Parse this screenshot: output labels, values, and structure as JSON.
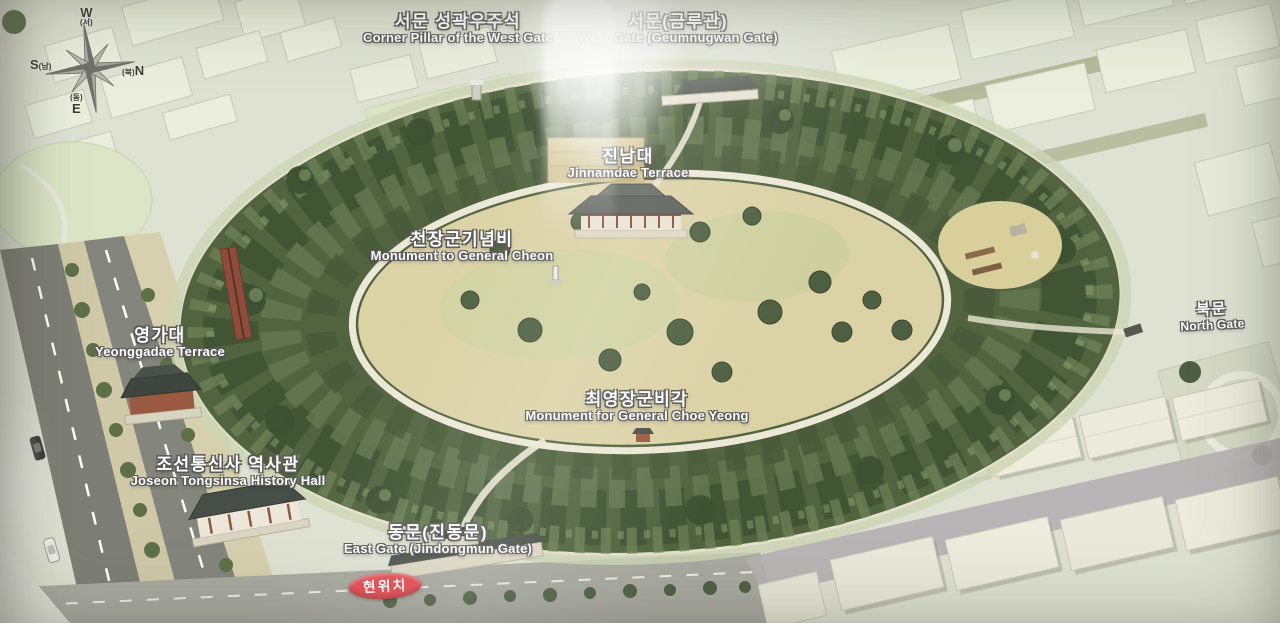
{
  "photo": {
    "alt": "Bird's-eye illustrated guide map of Jaseongdae fortress park"
  },
  "compass": {
    "west": {
      "letter": "W",
      "hangul": "(서)"
    },
    "south": {
      "letter": "S",
      "hangul": "(남)"
    },
    "north": {
      "letter": "N",
      "hangul": "(북)"
    },
    "east": {
      "letter": "E",
      "hangul": "(동)"
    }
  },
  "labels": [
    {
      "id": "corner-pillar-west-gate",
      "ko": "서문 성곽우주석",
      "en": "Corner Pillar of the West Gate"
    },
    {
      "id": "west-gate",
      "ko": "서문(금루관)",
      "en": "West Gate (Geumnugwan Gate)"
    },
    {
      "id": "jinnamdae-terrace",
      "ko": "진남대",
      "en": "Jinnamdae Terrace"
    },
    {
      "id": "monument-general-cheon",
      "ko": "천장군기념비",
      "en": "Monument to General Cheon"
    },
    {
      "id": "yeonggadae-terrace",
      "ko": "영가대",
      "en": "Yeonggadae Terrace"
    },
    {
      "id": "north-gate",
      "ko": "북문",
      "en": "North Gate"
    },
    {
      "id": "monument-general-choe",
      "ko": "최영장군비각",
      "en": "Monument for General Choe Yeong"
    },
    {
      "id": "joseon-tongsinsa-hall",
      "ko": "조선통신사 역사관",
      "en": "Joseon Tongsinsa History Hall"
    },
    {
      "id": "east-gate",
      "ko": "동문(진동문)",
      "en": "East Gate (Jindongmun Gate)"
    }
  ],
  "current_location_badge": {
    "text": "현위치",
    "bg_color": "#e8464d",
    "text_color": "#ffffff"
  },
  "colors": {
    "background": "#dfe2d3",
    "city_block": "#ebeedd",
    "block_shadow": "#99a077",
    "tree_ring": "#51643f",
    "tree_dark": "#3f5233",
    "tree_light": "#70835a",
    "clearing": "#dbd2a5",
    "lawn": "#ccd49f",
    "path": "#eae6d4",
    "road": "#7d7e75",
    "median": "#cfc9a8",
    "roof_dark": "#4c514a",
    "wood_red": "#8e4d3a"
  }
}
